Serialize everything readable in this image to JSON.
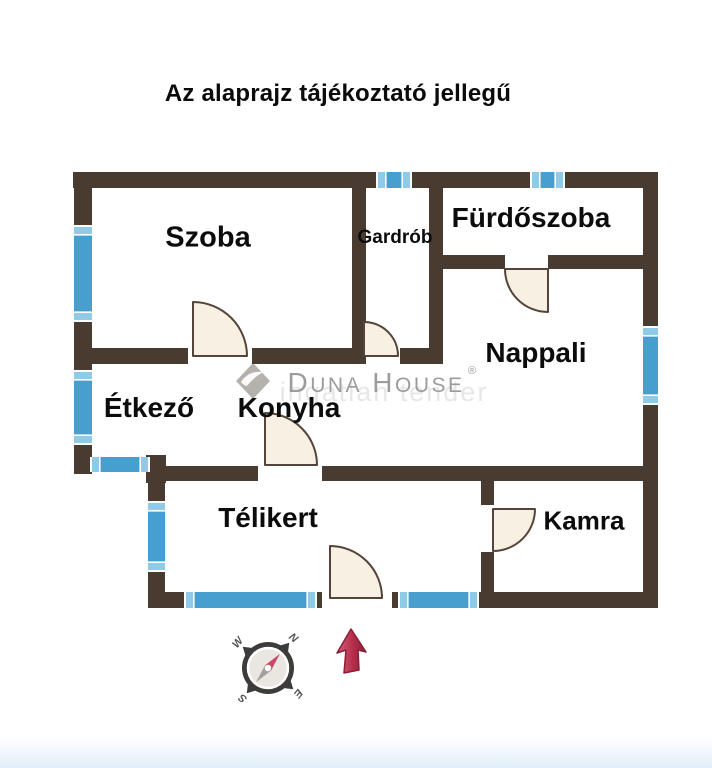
{
  "title": "Az alaprajz tájékoztató jellegű",
  "watermark": {
    "brand": "Duna House",
    "registered": "®",
    "background_text": "ingatlan tender"
  },
  "compass": {
    "letters": [
      "N",
      "E",
      "S",
      "W"
    ],
    "rotation": 40,
    "center": [
      268,
      668
    ]
  },
  "colors": {
    "wall": "#4a3b31",
    "window": "#479fd0",
    "window_cap": "#8fcbe7",
    "door_fill": "#f8f0e2",
    "door_stroke": "#554439",
    "label": "#0c0c0c",
    "watermark_gray": "#9c9c9c",
    "watermark_shadow": "#e3e3e3",
    "logo_gray": "#b4b1ae",
    "compass_ring": "#3d3c3a",
    "compass_face": "#eae7e3",
    "needle_north": "#c84a67",
    "needle_south": "#a3a19d",
    "compass_text": "#555555",
    "arrow_stroke": "#8a1f35"
  },
  "floorplan": {
    "rooms": [
      {
        "label": "Szoba",
        "x": 208,
        "y": 236,
        "fs": 29
      },
      {
        "label": "Gardrób",
        "x": 395,
        "y": 236,
        "fs": 19
      },
      {
        "label": "Fürdőszoba",
        "x": 531,
        "y": 217,
        "fs": 28
      },
      {
        "label": "Nappali",
        "x": 536,
        "y": 352,
        "fs": 28
      },
      {
        "label": "Étkező",
        "x": 149,
        "y": 407,
        "fs": 28
      },
      {
        "label": "Konyha",
        "x": 289,
        "y": 407,
        "fs": 28
      },
      {
        "label": "Télikert",
        "x": 268,
        "y": 517,
        "fs": 28
      },
      {
        "label": "Kamra",
        "x": 584,
        "y": 520,
        "fs": 26
      }
    ],
    "walls": [
      [
        73,
        172,
        305,
        16
      ],
      [
        410,
        172,
        122,
        16
      ],
      [
        563,
        172,
        95,
        16
      ],
      [
        74,
        172,
        18,
        55
      ],
      [
        74,
        320,
        18,
        52
      ],
      [
        74,
        443,
        18,
        31
      ],
      [
        146,
        455,
        20,
        28
      ],
      [
        166,
        466,
        92,
        15
      ],
      [
        322,
        466,
        336,
        15
      ],
      [
        148,
        472,
        17,
        31
      ],
      [
        148,
        570,
        17,
        38
      ],
      [
        148,
        592,
        38,
        16
      ],
      [
        315,
        592,
        7,
        16
      ],
      [
        392,
        592,
        8,
        16
      ],
      [
        477,
        592,
        181,
        16
      ],
      [
        643,
        172,
        15,
        156
      ],
      [
        643,
        403,
        15,
        205
      ],
      [
        352,
        188,
        14,
        176
      ],
      [
        429,
        188,
        14,
        176
      ],
      [
        92,
        348,
        96,
        16
      ],
      [
        252,
        348,
        100,
        16
      ],
      [
        400,
        348,
        43,
        16
      ],
      [
        443,
        255,
        62,
        14
      ],
      [
        548,
        255,
        95,
        14
      ],
      [
        481,
        481,
        13,
        24
      ],
      [
        481,
        552,
        13,
        40
      ]
    ],
    "windows": [
      {
        "x": 74,
        "y": 227,
        "w": 18,
        "h": 93,
        "o": "v"
      },
      {
        "x": 74,
        "y": 372,
        "w": 18,
        "h": 71,
        "o": "v"
      },
      {
        "x": 378,
        "y": 172,
        "w": 32,
        "h": 16,
        "o": "h"
      },
      {
        "x": 532,
        "y": 172,
        "w": 31,
        "h": 16,
        "o": "h"
      },
      {
        "x": 643,
        "y": 328,
        "w": 15,
        "h": 75,
        "o": "v"
      },
      {
        "x": 92,
        "y": 457,
        "w": 56,
        "h": 15,
        "o": "h"
      },
      {
        "x": 148,
        "y": 503,
        "w": 17,
        "h": 67,
        "o": "v"
      },
      {
        "x": 186,
        "y": 592,
        "w": 129,
        "h": 16,
        "o": "h"
      },
      {
        "x": 400,
        "y": 592,
        "w": 77,
        "h": 16,
        "o": "h"
      }
    ],
    "doors": [
      {
        "cx": 193,
        "cy": 356,
        "r": 54,
        "dir": "up-right",
        "room": "szoba"
      },
      {
        "cx": 364,
        "cy": 356,
        "r": 34,
        "dir": "up-right",
        "room": "gardrob"
      },
      {
        "cx": 548,
        "cy": 269,
        "r": 43,
        "dir": "down-left",
        "room": "furdoszoba"
      },
      {
        "cx": 265,
        "cy": 465,
        "r": 52,
        "dir": "up-right",
        "room": "konyha"
      },
      {
        "cx": 330,
        "cy": 598,
        "r": 52,
        "dir": "up-right",
        "room": "telikert"
      },
      {
        "cx": 493,
        "cy": 509,
        "r": 42,
        "dir": "right-down",
        "room": "kamra"
      }
    ]
  }
}
